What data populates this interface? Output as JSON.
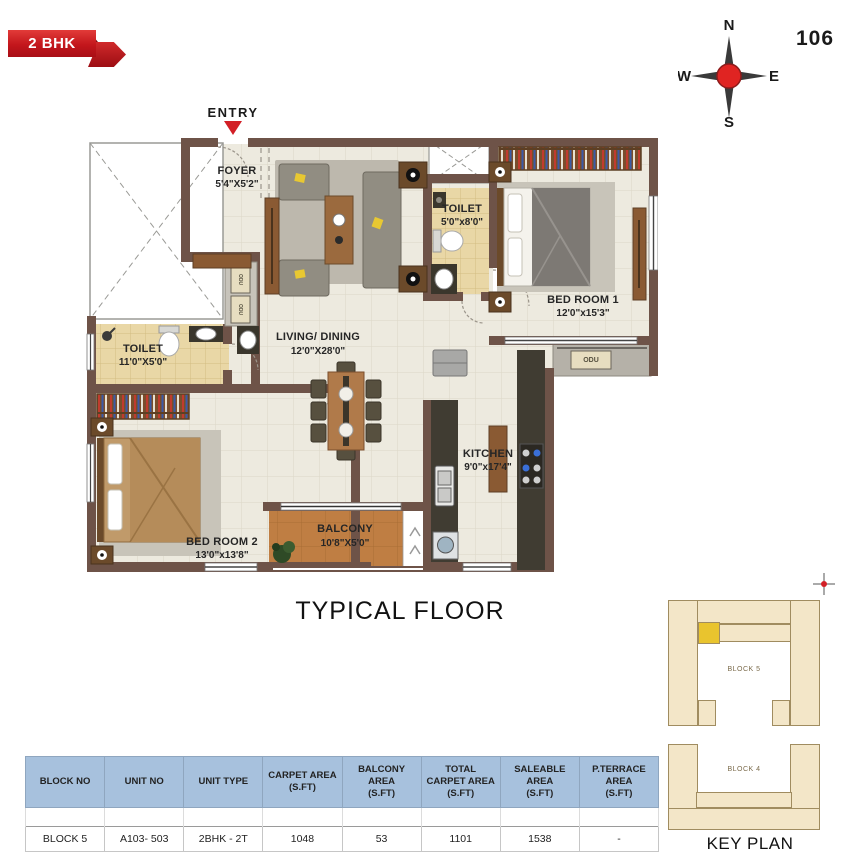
{
  "badge": {
    "label": "2 BHK"
  },
  "page_number": "106",
  "compass": {
    "n": "N",
    "e": "E",
    "s": "S",
    "w": "W"
  },
  "plan": {
    "entry_label": "ENTRY",
    "rooms": {
      "foyer": {
        "name": "FOYER",
        "dims": "5'4\"X5'2\""
      },
      "living": {
        "name": "LIVING/ DINING",
        "dims": "12'0\"X28'0\""
      },
      "toilet1": {
        "name": "TOILET",
        "dims": "5'0\"x8'0\""
      },
      "bedroom1": {
        "name": "BED ROOM 1",
        "dims": "12'0\"x15'3\""
      },
      "toilet2": {
        "name": "TOILET",
        "dims": "11'0\"X5'0\""
      },
      "bedroom2": {
        "name": "BED ROOM 2",
        "dims": "13'0\"x13'8\""
      },
      "kitchen": {
        "name": "KITCHEN",
        "dims": "9'0\"x17'4\""
      },
      "balcony": {
        "name": "BALCONY",
        "dims": "10'8\"X5'0\""
      }
    },
    "odu_label": "ODU"
  },
  "floor_title": "TYPICAL FLOOR",
  "table": {
    "headers": [
      "BLOCK NO",
      "UNIT NO",
      "UNIT TYPE",
      "CARPET AREA\n(S.FT)",
      "BALCONY AREA\n(S.FT)",
      "TOTAL\nCARPET AREA\n(S.FT)",
      "SALEABLE AREA\n(S.FT)",
      "P.TERRACE AREA\n(S.FT)"
    ],
    "row": [
      "BLOCK 5",
      "A103- 503",
      "2BHK - 2T",
      "1048",
      "53",
      "1101",
      "1538",
      "-"
    ]
  },
  "key_plan": {
    "title": "KEY PLAN",
    "block5": "BLOCK 5",
    "block4": "BLOCK 4"
  },
  "colors": {
    "accent_red": "#c3161c",
    "wall_brown": "#6e5348",
    "table_header_blue": "#a7c1dd",
    "keyplan_beige": "#f3e6c8",
    "keyplan_highlight": "#e9c42e"
  }
}
